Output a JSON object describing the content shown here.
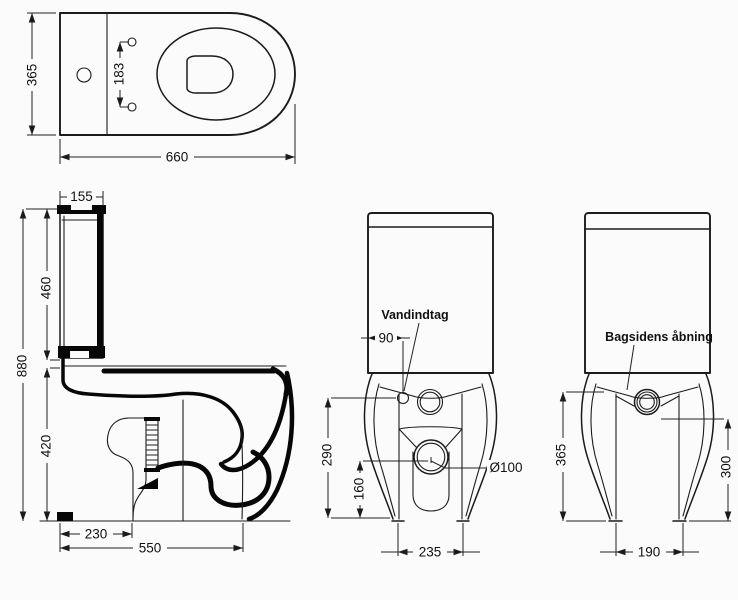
{
  "drawing": {
    "background_color": "#fbfbfb",
    "line_color": "#1b1b1b",
    "views": {
      "top": {
        "dims": {
          "depth": "365",
          "seat_hole_spacing": "183",
          "length": "660"
        }
      },
      "side": {
        "dims": {
          "cistern_width": "155",
          "cistern_height": "460",
          "total_height": "880",
          "bowl_height": "420",
          "trap_offset": "230",
          "base_depth": "550"
        }
      },
      "front": {
        "labels": {
          "water_inlet": "Vandindtag"
        },
        "dims": {
          "inlet_offset": "90",
          "inlet_height": "290",
          "outlet_height": "160",
          "outlet_diameter": "Ø100",
          "base_width": "235"
        }
      },
      "back": {
        "labels": {
          "rear_opening": "Bagsidens åbning"
        },
        "dims": {
          "opening_height": "365",
          "outlet_height": "300",
          "base_width": "190"
        }
      }
    }
  }
}
